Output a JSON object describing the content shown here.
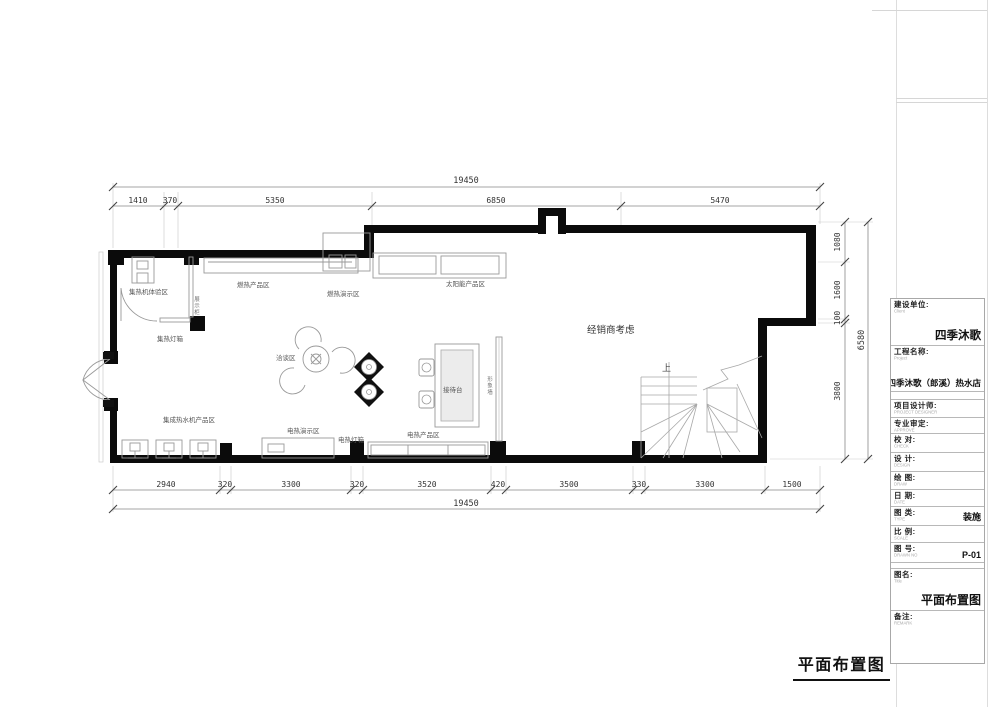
{
  "frame": {
    "footer_title": "平面布置图"
  },
  "plan": {
    "dimensions": {
      "top_total": "19450",
      "top_segments": [
        "1410",
        "370",
        "5350",
        "6850",
        "5470"
      ],
      "right_segments": [
        "1080",
        "1600",
        "100",
        "3800"
      ],
      "right_total": "6580",
      "bottom_segments": [
        "2940",
        "320",
        "3300",
        "320",
        "3520",
        "420",
        "3500",
        "330",
        "3300",
        "1500"
      ],
      "bottom_total": "19450"
    },
    "areas": {
      "collector_experience": "集热机体验区",
      "collector_lightbox": "集热灯箱",
      "display_cabinet": "展示柜",
      "gas_products": "燃热产品区",
      "gas_demo": "燃热演示区",
      "solar_products": "太阳能产品区",
      "negotiation": "洽谈区",
      "reception_desk": "接待台",
      "feature_wall": "形象墙",
      "dealer_note": "经销商考虑",
      "integrated_heater_products": "集成热水机产品区",
      "electric_demo": "电热演示区",
      "electric_lightbox": "电热灯箱",
      "electric_products": "电热产品区",
      "stairs_up": "上"
    }
  },
  "title_block": {
    "rows": [
      {
        "label": "建设单位:",
        "sub": "Client",
        "value": "四季沐歌"
      },
      {
        "label": "工程名称:",
        "sub": "Project",
        "value": "四季沐歌（郎溪）热水店"
      },
      {
        "label": "项目设计师:",
        "sub": "PROJECT DESIGNER",
        "value": ""
      },
      {
        "label": "专业审定:",
        "sub": "APPROVE",
        "value": ""
      },
      {
        "label": "校 对:",
        "sub": "CHECK",
        "value": ""
      },
      {
        "label": "设 计:",
        "sub": "DESIGN",
        "value": ""
      },
      {
        "label": "绘 图:",
        "sub": "DRAW",
        "value": ""
      },
      {
        "label": "日 期:",
        "sub": "DATE",
        "value": ""
      },
      {
        "label": "图 类:",
        "sub": "TYPE",
        "value": "装施"
      },
      {
        "label": "比 例:",
        "sub": "SCALE",
        "value": ""
      },
      {
        "label": "图 号:",
        "sub": "DRAWN NO",
        "value": "P-01"
      },
      {
        "label": "图名:",
        "sub": "Title",
        "value": "平面布置图"
      },
      {
        "label": "备注:",
        "sub": "REMARK",
        "value": ""
      }
    ]
  }
}
